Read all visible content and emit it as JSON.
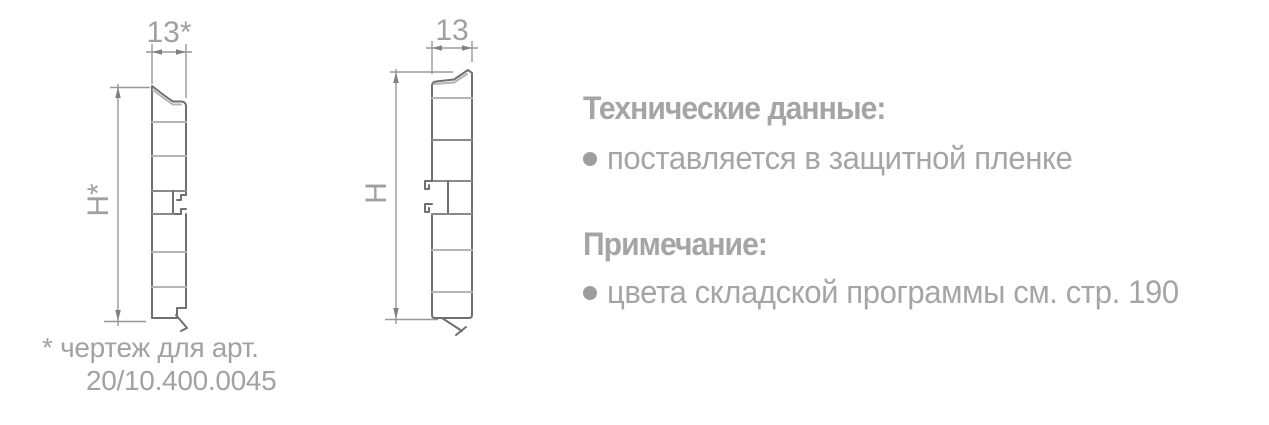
{
  "drawing_left": {
    "width_label": "13*",
    "height_label": "H*",
    "footnote_line1": "* чертеж для арт.",
    "footnote_line2": "20/10.400.0045"
  },
  "drawing_right": {
    "width_label": "13",
    "height_label": "H"
  },
  "tech_data": {
    "heading": "Технические данные:",
    "items": [
      {
        "text": "поставляется в защитной пленке"
      }
    ]
  },
  "note": {
    "heading": "Примечание:",
    "items": [
      {
        "text": "цвета складской программы см. стр. 190"
      }
    ]
  },
  "colors": {
    "text_gray": "#a5a5a8",
    "dimension_line": "#98989b",
    "profile_outline": "#707073",
    "profile_web": "#b5b5b7",
    "background": "#ffffff"
  }
}
